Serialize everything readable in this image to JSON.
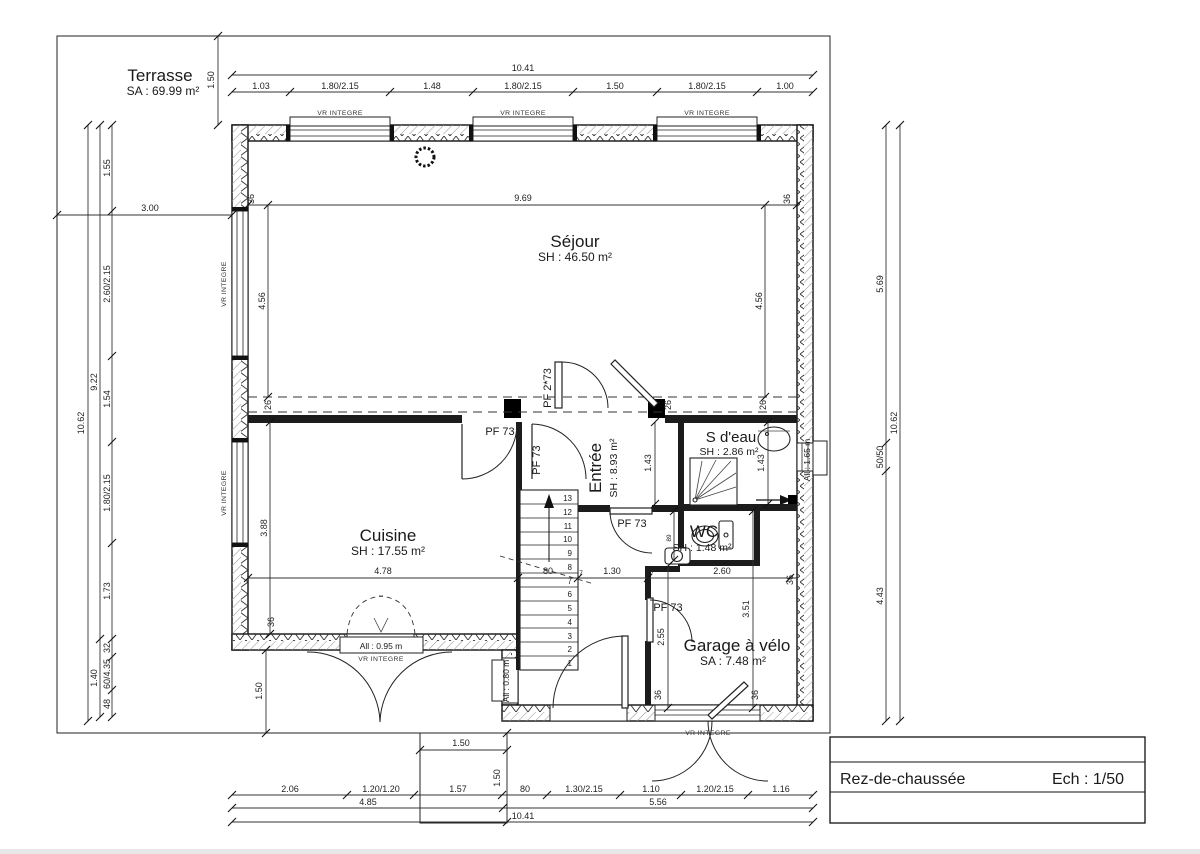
{
  "drawing": {
    "title": "Rez-de-chaussée",
    "scale": "Ech : 1/50"
  },
  "rooms": {
    "terrasse": {
      "name": "Terrasse",
      "area": "SA : 69.99 m²"
    },
    "sejour": {
      "name": "Séjour",
      "area": "SH : 46.50 m²"
    },
    "cuisine": {
      "name": "Cuisine",
      "area": "SH : 17.55 m²"
    },
    "entree": {
      "name": "Entrée",
      "area": "SH : 8.93 m²"
    },
    "salle_eau": {
      "name": "S d'eau",
      "area": "SH : 2.86 m²"
    },
    "wc": {
      "name": "WC",
      "area": "SH : 1.48 m²"
    },
    "garage": {
      "name": "Garage à vélo",
      "area": "SA : 7.48 m²"
    }
  },
  "labels": {
    "vr_integre": "VR INTEGRE",
    "pf73": "PF 73",
    "pf273": "PF 2*73",
    "all_095": "All : 0.95 m",
    "all_080": "All : 0.80 m",
    "all_165": "All : 1.65 m"
  },
  "dims": {
    "top": {
      "total": "10.41",
      "segs": [
        "1.03",
        "1.80/2.15",
        "1.48",
        "1.80/2.15",
        "1.50",
        "1.80/2.15",
        "1.00"
      ]
    },
    "left": {
      "outer": "10.62",
      "chain": "9.22",
      "lower": "1.40",
      "terrace_depth": "3.00",
      "terrace_edge": "1.50",
      "cuisine_step": "1.50",
      "segs": [
        "1.55",
        "2.60/2.15",
        "1.54",
        "1.80/2.15",
        "1.73",
        "32",
        "60/4.35",
        "48"
      ]
    },
    "right": {
      "outer": "10.62",
      "segs": [
        "5.69",
        "50/50",
        "4.43"
      ]
    },
    "bottom": {
      "total": "10.41",
      "row2": [
        "4.85",
        "5.56"
      ],
      "step_w": "1.50",
      "step_h": "1.50",
      "segs": [
        "2.06",
        "1.20/1.20",
        "1.57",
        "80",
        "1.30/2.15",
        "1.10",
        "1.20/2.15",
        "1.16"
      ]
    },
    "interior": {
      "sejour_w": "9.69",
      "wall36": "36",
      "sejour_h": "4.56",
      "beam": "26",
      "cuisine_h": "3.88",
      "cuisine_w": "4.78",
      "stair_w": "80",
      "seven": "7",
      "hall_w": "1.30",
      "right_w": "2.60",
      "entree_h": "1.43",
      "wc_w": "89",
      "garage_h": "2.55",
      "garage_right_h": "3.51"
    }
  },
  "stairs": {
    "treads": [
      "1",
      "2",
      "3",
      "4",
      "5",
      "6",
      "7",
      "8",
      "9",
      "10",
      "11",
      "12",
      "13"
    ]
  }
}
